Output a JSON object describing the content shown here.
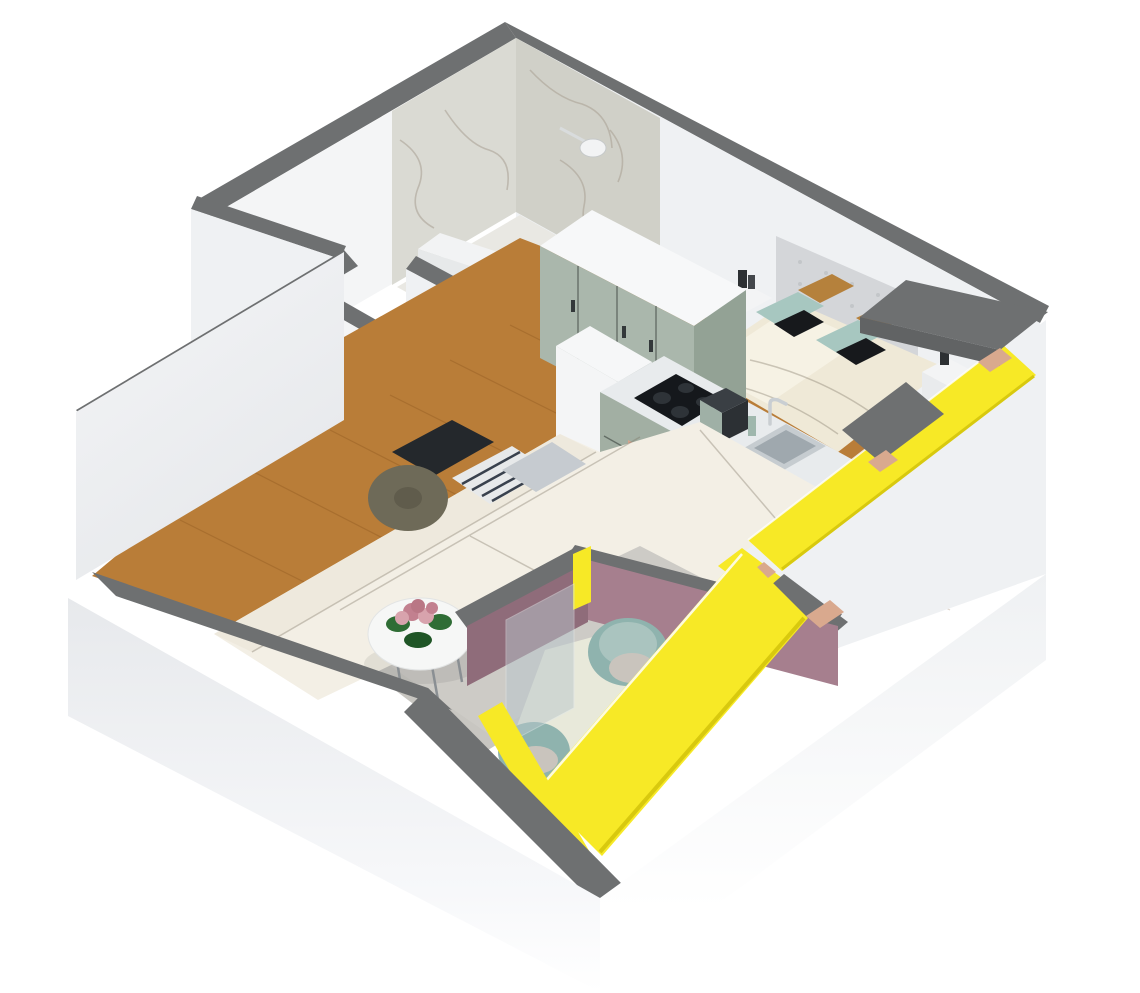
{
  "scene": {
    "kind": "3d-floorplan-cutaway-render",
    "view": "isometric-from-above",
    "background": "#ffffff",
    "apartment_type": "one-bedroom apartment with loggia balcony"
  },
  "palette": {
    "bg": "#ffffff",
    "wall_top_gray": "#6e7071",
    "wall_top_gray_dark": "#616364",
    "wall_face_white": "#eff1f3",
    "wall_face_light": "#f4f5f6",
    "wall_face_shaded": "#e6e8ea",
    "wall_face_dark": "#dcdee0",
    "marble_light": "#dadad3",
    "marble_dark": "#d0d0c8",
    "wood_floor": "#b97d38",
    "wood_threshold": "#b5722f",
    "bath_fixture_white": "#f2f3f4",
    "washer_door_dark": "#2b2e33",
    "toilet_dark": "#26292c",
    "wardrobe_sage": "#aab7ac",
    "wardrobe_sage_side": "#93a295",
    "cabinet_sage": "#a2afa3",
    "cabinet_sage_dark": "#8fa092",
    "counter_white": "#e8ebed",
    "hob_black": "#15181c",
    "oven_copper": "#d5a58f",
    "oven_glass": "#23262b",
    "sink_steel": "#c6ccd0",
    "sink_steel_inner": "#9fa8ae",
    "appliance_dark": "#3a3f44",
    "headboard_gray": "#d4d6d9",
    "duvet_cream": "#efe9d7",
    "duvet_highlight": "#f6f2e4",
    "pillow_teal": "#a7c7c0",
    "pillow_black": "#17191c",
    "pillow_caramel": "#b5813c",
    "nightstand_white": "#f3f4f5",
    "sofa_cream": "#f3efe5",
    "sofa_back_cream": "#eee9dd",
    "cushion_dark": "#24282c",
    "cushion_olive": "#6e6a58",
    "cushion_stripe_base": "#e7e9ea",
    "cushion_gray": "#c6cbd0",
    "rug_gray": "#c8c6c1",
    "coffee_table_white": "#f6f7f6",
    "flower_pink": "#c2808f",
    "flower_pink_light": "#d8a3ad",
    "leaf_green": "#2f6d35",
    "dining_table_white": "#f5f6f5",
    "chair_sage": "#9db3ac",
    "window_frame_yellow": "#f7e926",
    "window_frame_yellow_dark": "#d8c90e",
    "sill_copper": "#d9a98e",
    "balcony_mauve": "#a67f8e",
    "balcony_mauve_dark": "#8f6c7a",
    "balcony_floor": "#e8e9da",
    "balcony_chair_teal": "#8fb3ae",
    "balcony_chair_seat": "#aac4bf",
    "balcony_cushion": "#c9c4bd",
    "glass_pane": "#b9c7cc",
    "slab_white": "#eceef0",
    "shower_chrome": "#d9dcdd"
  },
  "rooms": [
    {
      "name": "bathroom",
      "finish": "white marble walls",
      "fixtures": [
        "shower-head",
        "half-wall-ledge",
        "washing-machine",
        "toilet",
        "wood-threshold"
      ]
    },
    {
      "name": "hallway",
      "finish": "white walls, oak floor",
      "fixtures": []
    },
    {
      "name": "bedroom",
      "finish": "white walls, oak floor",
      "fixtures": [
        "double-bed",
        "tufted-headboard",
        "nightstand-left",
        "nightstand-right",
        "wardrobe"
      ]
    },
    {
      "name": "kitchen",
      "finish": "sage cabinets, white counter",
      "fixtures": [
        "tall-fridge-unit",
        "gas-hob",
        "oven",
        "sink",
        "faucet",
        "coffee-machine"
      ]
    },
    {
      "name": "living-room",
      "finish": "oak floor, gray rug",
      "fixtures": [
        "l-shaped-sofa",
        "throw-pillows",
        "round-coffee-table",
        "flower-centerpiece"
      ]
    },
    {
      "name": "dining-nook",
      "fixtures": [
        "white-table",
        "plant",
        "sage-chair"
      ]
    },
    {
      "name": "balcony",
      "finish": "mauve walls, yellow window frames",
      "fixtures": [
        "round-chair-1",
        "round-chair-2",
        "glass-partition"
      ]
    }
  ],
  "windows": {
    "frame_color_name": "yellow",
    "count_bands": 4,
    "sill_accent": "copper"
  }
}
